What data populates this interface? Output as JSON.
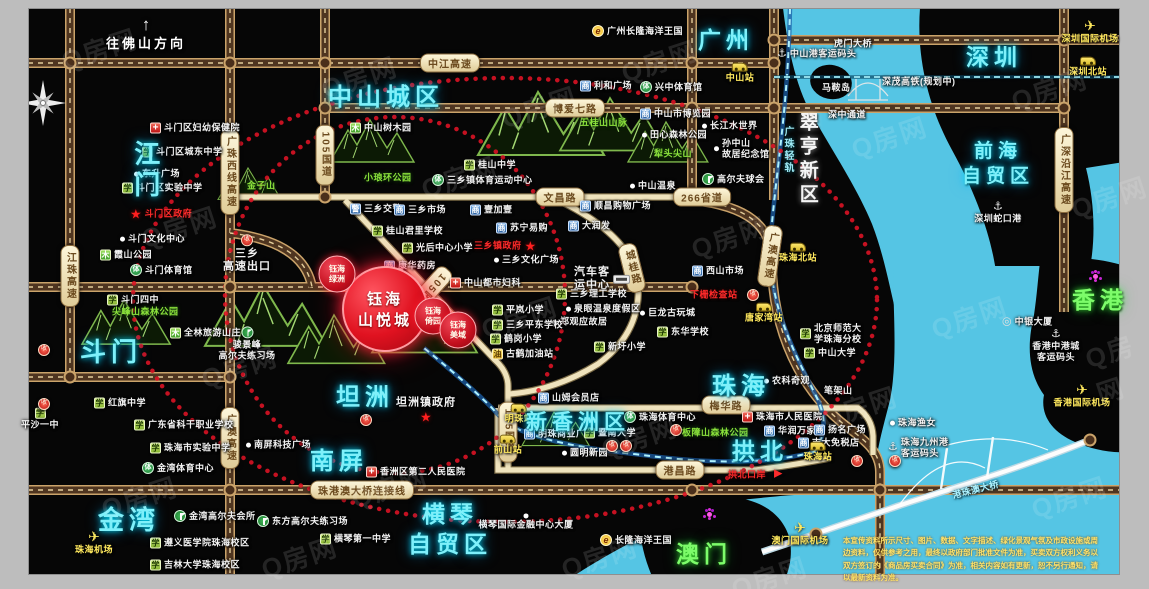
{
  "watermark": "Q房网",
  "direction_sign": {
    "arrow": "↑",
    "label": "往佛山方向"
  },
  "project": {
    "main": {
      "line1": "钰海",
      "line2": "山悦城",
      "x": 385,
      "y": 309
    },
    "subs": [
      {
        "label": "钰海\n绿洲",
        "x": 337,
        "y": 274
      },
      {
        "label": "钰海\n倚园",
        "x": 433,
        "y": 316
      },
      {
        "label": "钰海\n美域",
        "x": 458,
        "y": 330
      }
    ]
  },
  "colors": {
    "water": "#55c5e4",
    "road_dark": "#4f3520",
    "road_casing": "#caa36a",
    "road_light": "#efe3bd",
    "ring_red": "#e01325",
    "accent_red": "#e01220",
    "label_cyan": "#7ef0fa",
    "label_green": "#7dfc6a",
    "station_yellow": "#ffe95e"
  },
  "regions": [
    {
      "l": "江门",
      "x": 128,
      "y": 140,
      "s": 26,
      "v": 1
    },
    {
      "l": "斗门",
      "x": 80,
      "y": 336,
      "s": 26
    },
    {
      "l": "金湾",
      "x": 98,
      "y": 504,
      "s": 26
    },
    {
      "l": "中山城区",
      "x": 328,
      "y": 82,
      "s": 24
    },
    {
      "l": "坦洲",
      "x": 336,
      "y": 382,
      "s": 24
    },
    {
      "l": "南屏",
      "x": 310,
      "y": 446,
      "s": 24
    },
    {
      "l": "新香洲区",
      "x": 526,
      "y": 409,
      "s": 21
    },
    {
      "l": "珠海",
      "x": 712,
      "y": 371,
      "s": 24
    },
    {
      "l": "拱北",
      "x": 732,
      "y": 437,
      "s": 23
    },
    {
      "l": "横琴\n自贸区",
      "x": 408,
      "y": 500,
      "s": 23,
      "a": 1
    },
    {
      "l": "广州",
      "x": 698,
      "y": 26,
      "s": 23
    },
    {
      "l": "深圳",
      "x": 966,
      "y": 43,
      "s": 23
    },
    {
      "l": "前海\n自贸区",
      "x": 962,
      "y": 140,
      "s": 19,
      "a": 1
    },
    {
      "l": "翠亨新区",
      "x": 794,
      "y": 112,
      "s": 19,
      "v": 1,
      "k": "white"
    },
    {
      "l": "澳门",
      "x": 676,
      "y": 540,
      "s": 23,
      "k": "green"
    },
    {
      "l": "香港",
      "x": 1072,
      "y": 286,
      "s": 23,
      "k": "green"
    },
    {
      "l": "广珠轻轨",
      "x": 781,
      "y": 126,
      "s": 10,
      "v": 1,
      "k": "rail"
    }
  ],
  "road_badges": [
    {
      "l": "中江高速",
      "x": 450,
      "y": 63
    },
    {
      "l": "博爱七路",
      "x": 575,
      "y": 108
    },
    {
      "l": "文昌路",
      "x": 560,
      "y": 197
    },
    {
      "l": "266省道",
      "x": 702,
      "y": 197
    },
    {
      "l": "105国道",
      "x": 325,
      "y": 155,
      "v": 1
    },
    {
      "l": "105国道",
      "x": 428,
      "y": 292,
      "v": 1,
      "r": 42
    },
    {
      "l": "105国道",
      "x": 508,
      "y": 432,
      "v": 1
    },
    {
      "l": "江珠高速",
      "x": 70,
      "y": 276,
      "v": 1
    },
    {
      "l": "广珠西线高速",
      "x": 230,
      "y": 172,
      "v": 1
    },
    {
      "l": "广澳高速",
      "x": 230,
      "y": 438,
      "v": 1
    },
    {
      "l": "广澳高速",
      "x": 770,
      "y": 256,
      "v": 1,
      "r": 8
    },
    {
      "l": "广深沿江高速",
      "x": 1064,
      "y": 170,
      "v": 1
    },
    {
      "l": "城桂路",
      "x": 632,
      "y": 268,
      "v": 1,
      "r": -14
    },
    {
      "l": "梅华路",
      "x": 726,
      "y": 405
    },
    {
      "l": "港昌路",
      "x": 680,
      "y": 470
    },
    {
      "l": "珠港澳大桥连接线",
      "x": 362,
      "y": 490
    }
  ],
  "pois": [
    {
      "t": "hospital",
      "x": 150,
      "y": 128,
      "l": "斗门区妇幼保健院"
    },
    {
      "t": "school",
      "x": 142,
      "y": 152,
      "l": "斗门区城东中学"
    },
    {
      "t": "dot",
      "x": 134,
      "y": 174,
      "l": "东升广场"
    },
    {
      "t": "school",
      "x": 122,
      "y": 188,
      "l": "斗门区实验中学"
    },
    {
      "t": "gov",
      "x": 130,
      "y": 214,
      "l": "斗门区政府"
    },
    {
      "t": "dot",
      "x": 120,
      "y": 239,
      "l": "斗门文化中心"
    },
    {
      "t": "park",
      "x": 100,
      "y": 255,
      "l": "霞山公园"
    },
    {
      "t": "sport",
      "x": 130,
      "y": 270,
      "l": "斗门体育馆"
    },
    {
      "t": "school",
      "x": 107,
      "y": 300,
      "l": "斗门四中"
    },
    {
      "t": "parktext",
      "x": 112,
      "y": 312,
      "l": "尖峰山森林公园"
    },
    {
      "t": "park",
      "x": 170,
      "y": 333,
      "l": "全林旅游山庄"
    },
    {
      "t": "parktext",
      "x": 247,
      "y": 186,
      "l": "金子山"
    },
    {
      "t": "school",
      "x": 94,
      "y": 403,
      "l": "红旗中学"
    },
    {
      "t": "school",
      "x": 134,
      "y": 425,
      "l": "广东省科干职业学校"
    },
    {
      "t": "school",
      "x": 150,
      "y": 448,
      "l": "珠海市实验中学"
    },
    {
      "t": "sport",
      "x": 142,
      "y": 468,
      "l": "金湾体育中心"
    },
    {
      "t": "school",
      "x": 40,
      "y": 418,
      "l": "平沙一中",
      "p": "b"
    },
    {
      "t": "toll",
      "x": 38,
      "y": 350
    },
    {
      "t": "toll",
      "x": 38,
      "y": 404
    },
    {
      "t": "plane",
      "x": 94,
      "y": 541,
      "l": "珠海机场",
      "p": "b"
    },
    {
      "t": "golf",
      "x": 174,
      "y": 516,
      "l": "金湾高尔夫会所"
    },
    {
      "t": "school",
      "x": 150,
      "y": 543,
      "l": "遵义医学院珠海校区"
    },
    {
      "t": "school",
      "x": 150,
      "y": 565,
      "l": "吉林大学珠海校区"
    },
    {
      "t": "golf",
      "x": 257,
      "y": 521,
      "l": "东方高尔夫练习场"
    },
    {
      "t": "school",
      "x": 320,
      "y": 539,
      "l": "横琴第一中学"
    },
    {
      "t": "golf",
      "x": 247,
      "y": 342,
      "l": "骏景峰\n高尔夫练习场",
      "p": "b"
    },
    {
      "t": "toll",
      "x": 247,
      "y": 252,
      "l": "三乡\n高速出口",
      "p": "b",
      "c": "big"
    },
    {
      "t": "park",
      "x": 350,
      "y": 128,
      "l": "中山树木园"
    },
    {
      "t": "parktext",
      "x": 364,
      "y": 178,
      "l": "小琅环公园"
    },
    {
      "t": "school",
      "x": 464,
      "y": 165,
      "l": "桂山中学"
    },
    {
      "t": "sport",
      "x": 432,
      "y": 180,
      "l": "三乡镇体育运动中心"
    },
    {
      "t": "parktext",
      "x": 580,
      "y": 123,
      "l": "五桂山山脉"
    },
    {
      "t": "parktext",
      "x": 654,
      "y": 154,
      "l": "犁头尖山"
    },
    {
      "t": "market",
      "x": 640,
      "y": 114,
      "l": "中山市博览园"
    },
    {
      "t": "dot",
      "x": 642,
      "y": 135,
      "l": "田心森林公园"
    },
    {
      "t": "dot",
      "x": 702,
      "y": 126,
      "l": "长江水世界"
    },
    {
      "t": "dot",
      "x": 714,
      "y": 149,
      "l": "孙中山\n故居纪念馆"
    },
    {
      "t": "dot",
      "x": 630,
      "y": 186,
      "l": "中山温泉"
    },
    {
      "t": "golf",
      "x": 702,
      "y": 179,
      "l": "高尔夫球会"
    },
    {
      "t": "market",
      "x": 580,
      "y": 86,
      "l": "利和广场"
    },
    {
      "t": "sport",
      "x": 640,
      "y": 87,
      "l": "兴中体育馆"
    },
    {
      "t": "elogo",
      "x": 592,
      "y": 31,
      "l": "广州长隆海洋王国"
    },
    {
      "t": "police",
      "x": 350,
      "y": 209,
      "l": "三乡交警"
    },
    {
      "t": "market",
      "x": 394,
      "y": 210,
      "l": "三乡市场"
    },
    {
      "t": "school",
      "x": 372,
      "y": 231,
      "l": "桂山君里学校"
    },
    {
      "t": "school",
      "x": 402,
      "y": 248,
      "l": "光后中心小学"
    },
    {
      "t": "market",
      "x": 384,
      "y": 266,
      "l": "康华药房"
    },
    {
      "t": "hospital",
      "x": 450,
      "y": 283,
      "l": "中山都市妇科"
    },
    {
      "t": "market",
      "x": 470,
      "y": 210,
      "l": "壹加壹"
    },
    {
      "t": "market",
      "x": 496,
      "y": 228,
      "l": "苏宁易购"
    },
    {
      "t": "market",
      "x": 580,
      "y": 206,
      "l": "顺昌购物广场"
    },
    {
      "t": "market",
      "x": 568,
      "y": 226,
      "l": "大润发"
    },
    {
      "t": "govafter",
      "x": 474,
      "y": 246,
      "l": "三乡镇政府"
    },
    {
      "t": "dot",
      "x": 494,
      "y": 260,
      "l": "三乡文化广场"
    },
    {
      "t": "bus",
      "x": 574,
      "y": 279,
      "l": "汽车客\n运中心",
      "p": "l",
      "c": "big"
    },
    {
      "t": "school",
      "x": 556,
      "y": 294,
      "l": "三乡理工学校"
    },
    {
      "t": "dot",
      "x": 566,
      "y": 309,
      "l": "泉眼温泉度假区"
    },
    {
      "t": "dot",
      "x": 552,
      "y": 322,
      "l": "郑观应故居"
    },
    {
      "t": "dot",
      "x": 640,
      "y": 313,
      "l": "巨龙古玩城"
    },
    {
      "t": "market",
      "x": 692,
      "y": 271,
      "l": "西山市场"
    },
    {
      "t": "redtext",
      "x": 690,
      "y": 295,
      "l": "下栅检查站"
    },
    {
      "t": "toll",
      "x": 747,
      "y": 295
    },
    {
      "t": "school",
      "x": 657,
      "y": 332,
      "l": "东华学校"
    },
    {
      "t": "school",
      "x": 594,
      "y": 347,
      "l": "新圩小学"
    },
    {
      "t": "school",
      "x": 492,
      "y": 310,
      "l": "平岚小学"
    },
    {
      "t": "school",
      "x": 492,
      "y": 325,
      "l": "三乡平东学校"
    },
    {
      "t": "school",
      "x": 490,
      "y": 339,
      "l": "鹤岗小学"
    },
    {
      "t": "fuel",
      "x": 492,
      "y": 354,
      "l": "古鹤加油站"
    },
    {
      "t": "redtext",
      "x": 396,
      "y": 403,
      "l": "坦洲镇政府",
      "c": "big"
    },
    {
      "t": "star",
      "x": 420,
      "y": 417
    },
    {
      "t": "toll",
      "x": 360,
      "y": 420
    },
    {
      "t": "hospital",
      "x": 366,
      "y": 472,
      "l": "香洲区第二人民医院"
    },
    {
      "t": "dot",
      "x": 246,
      "y": 445,
      "l": "南屏科技广场"
    },
    {
      "t": "market",
      "x": 538,
      "y": 398,
      "l": "山姆会员店"
    },
    {
      "t": "sport",
      "x": 624,
      "y": 417,
      "l": "珠海体育中心"
    },
    {
      "t": "toll",
      "x": 670,
      "y": 430
    },
    {
      "t": "parktext",
      "x": 682,
      "y": 433,
      "l": "板障山森林公园"
    },
    {
      "t": "train",
      "x": 519,
      "y": 413,
      "l": "明珠站",
      "p": "b"
    },
    {
      "t": "market",
      "x": 524,
      "y": 434,
      "l": "明珠商业广场"
    },
    {
      "t": "train",
      "x": 508,
      "y": 444,
      "l": "前山站",
      "p": "b"
    },
    {
      "t": "dot",
      "x": 562,
      "y": 453,
      "l": "圆明新园"
    },
    {
      "t": "school",
      "x": 584,
      "y": 433,
      "l": "暨南大学"
    },
    {
      "t": "toll",
      "x": 606,
      "y": 446
    },
    {
      "t": "toll",
      "x": 620,
      "y": 446
    },
    {
      "t": "dot",
      "x": 764,
      "y": 381,
      "l": "农科奇观"
    },
    {
      "t": "text",
      "x": 824,
      "y": 391,
      "l": "笔架山"
    },
    {
      "t": "hospital",
      "x": 742,
      "y": 417,
      "l": "珠海市人民医院"
    },
    {
      "t": "market",
      "x": 764,
      "y": 431,
      "l": "华润万家"
    },
    {
      "t": "market",
      "x": 814,
      "y": 430,
      "l": "扬名广场"
    },
    {
      "t": "market",
      "x": 798,
      "y": 443,
      "l": "吉大免税店"
    },
    {
      "t": "train",
      "x": 818,
      "y": 451,
      "l": "珠海站",
      "p": "b"
    },
    {
      "t": "toll",
      "x": 851,
      "y": 461
    },
    {
      "t": "toll",
      "x": 889,
      "y": 461
    },
    {
      "t": "redtext",
      "x": 728,
      "y": 475,
      "l": "拱北口岸"
    },
    {
      "t": "redarrow",
      "x": 774,
      "y": 474
    },
    {
      "t": "dot",
      "x": 890,
      "y": 423,
      "l": "珠海渔女"
    },
    {
      "t": "anchor",
      "x": 888,
      "y": 448,
      "l": "珠海九州港\n客运码头"
    },
    {
      "t": "school",
      "x": 800,
      "y": 334,
      "l": "北京师范大\n学珠海分校"
    },
    {
      "t": "school",
      "x": 804,
      "y": 353,
      "l": "中山大学"
    },
    {
      "t": "anchor",
      "x": 777,
      "y": 54,
      "l": "中山港客运码头"
    },
    {
      "t": "text",
      "x": 834,
      "y": 44,
      "l": "虎门大桥"
    },
    {
      "t": "text",
      "x": 822,
      "y": 88,
      "l": "马鞍岛"
    },
    {
      "t": "text",
      "x": 828,
      "y": 115,
      "l": "深中通道"
    },
    {
      "t": "text",
      "x": 882,
      "y": 82,
      "l": "深茂高铁(规划中)"
    },
    {
      "t": "train",
      "x": 740,
      "y": 72,
      "l": "中山站",
      "p": "b"
    },
    {
      "t": "plane",
      "x": 1090,
      "y": 30,
      "l": "深圳国际机场",
      "p": "b"
    },
    {
      "t": "train",
      "x": 1088,
      "y": 66,
      "l": "深圳北站",
      "p": "b"
    },
    {
      "t": "anchor",
      "x": 998,
      "y": 212,
      "l": "深圳蛇口港",
      "p": "b"
    },
    {
      "t": "flower",
      "x": 1088,
      "y": 276
    },
    {
      "t": "landmark",
      "x": 1002,
      "y": 322,
      "l": "中银大厦"
    },
    {
      "t": "anchor",
      "x": 1056,
      "y": 344,
      "l": "香港中港城\n客运码头",
      "p": "b"
    },
    {
      "t": "plane",
      "x": 1082,
      "y": 394,
      "l": "香港国际机场",
      "p": "b"
    },
    {
      "t": "train",
      "x": 798,
      "y": 252,
      "l": "珠海北站",
      "p": "b"
    },
    {
      "t": "train",
      "x": 764,
      "y": 312,
      "l": "唐家湾站",
      "p": "b"
    },
    {
      "t": "plane",
      "x": 800,
      "y": 532,
      "l": "澳门国际机场",
      "p": "b"
    },
    {
      "t": "flower",
      "x": 702,
      "y": 514
    },
    {
      "t": "elogo",
      "x": 600,
      "y": 540,
      "l": "长隆海洋王国"
    },
    {
      "t": "dot",
      "x": 526,
      "y": 521,
      "l": "横琴国际金融中心大厦",
      "p": "b"
    },
    {
      "t": "bridgetext",
      "x": 952,
      "y": 490,
      "l": "港珠澳大桥",
      "r": -14
    }
  ],
  "disclaimer": {
    "line1": "本宣传资料所示尺寸、图片、数据、文字描述、绿化景观气氛及市政设施或周边资料，仅供参考之用，最终以政府部门批准文件为准，",
    "line2": "买卖双方权利义务以双方签订的《商品房买卖合同》为准，相关内容如有更新，恕不另行通知，请以最新资料为准。"
  }
}
